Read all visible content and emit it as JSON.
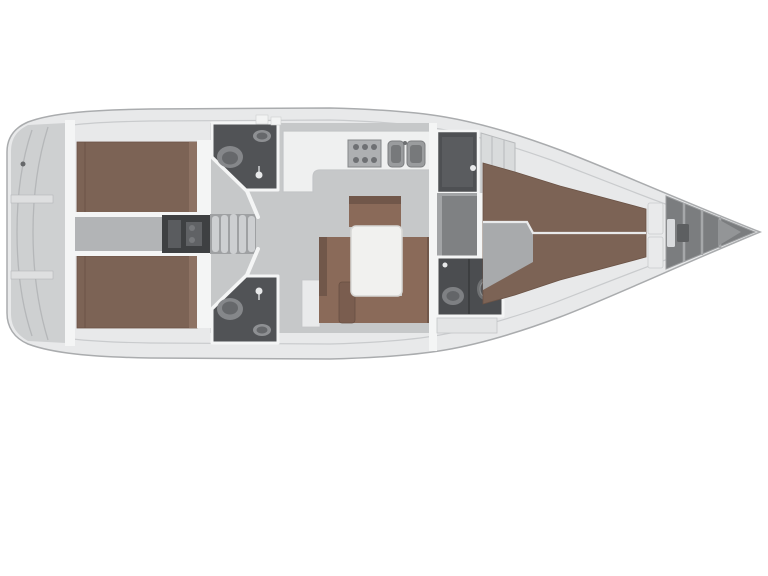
{
  "title": "Sailing yacht interior layout floor plan (top view, bow to the right)",
  "colors": {
    "background": "#ffffff",
    "hull_deck": "#e8e9ea",
    "hull_outline": "#aaacae",
    "inner_deck_line": "#c9cbcd",
    "transom_gray": "#ced0d1",
    "interior_floor": "#c6c8c9",
    "corridor_floor": "#b2b4b6",
    "berth_wood": "#7c6355",
    "berth_seam": "#6b5346",
    "berth_highlight": "#8d7263",
    "settee_wood": "#8a6a59",
    "settee_back": "#71574a",
    "stool_wood": "#7a5d4f",
    "table_top": "#f1f1ef",
    "table_edge": "#d8d8d6",
    "head_room": "#515356",
    "head_room_fwd": "#4b4d50",
    "fixture_light": "#85878a",
    "fixture_dark": "#66686b",
    "engine_dark": "#3e4042",
    "engine_detail": "#5a5c5f",
    "stair_frame": "#9fa1a3",
    "stair_tread": "#cdcfd1",
    "counter_white": "#eff0f0",
    "counter_edge": "#c3c5c7",
    "appliance_gray": "#aeb0b2",
    "sink_gray": "#9a9c9e",
    "sink_inner": "#77797b",
    "wet_room": "#4e5053",
    "wet_room_inner": "#5a5c5f",
    "locker_shelf": "#d9dbdc",
    "bow_locker": "#7b7d7f",
    "bow_rib": "#a6a8aa",
    "bow_wedge": "#939597",
    "wall_white": "#f4f5f5",
    "knob_white": "#e8e9ea",
    "cabinet_white": "#e9eaeb",
    "detail_line": "#b5b7b9"
  },
  "regions": [
    {
      "name": "stern-platform",
      "label": "Stern / transom platform"
    },
    {
      "name": "aft-cabin-port",
      "label": "Aft double cabin (port)"
    },
    {
      "name": "aft-cabin-starboard",
      "label": "Aft double cabin (starboard)"
    },
    {
      "name": "engine-compartment",
      "label": "Engine compartment"
    },
    {
      "name": "companionway-stairs",
      "label": "Companionway stairs"
    },
    {
      "name": "aft-head-port",
      "label": "Aft head / WC (port)"
    },
    {
      "name": "aft-head-starboard",
      "label": "Aft head / WC (starboard)"
    },
    {
      "name": "galley",
      "label": "Galley with stove and twin sinks"
    },
    {
      "name": "saloon",
      "label": "Saloon with U-settee and table"
    },
    {
      "name": "wet-locker",
      "label": "Shower / wet locker"
    },
    {
      "name": "forward-corridor",
      "label": "Passage to forward cabin"
    },
    {
      "name": "forward-head",
      "label": "Forward head with shower"
    },
    {
      "name": "forward-cabin",
      "label": "Forward owner cabin berth"
    },
    {
      "name": "anchor-locker",
      "label": "Bow anchor locker"
    }
  ]
}
